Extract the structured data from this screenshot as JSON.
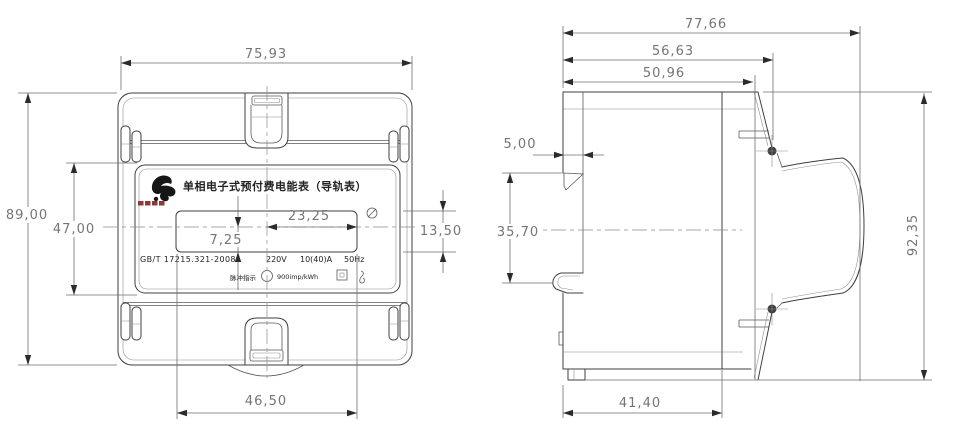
{
  "front": {
    "dims": {
      "overall_width": "75,93",
      "overall_height": "89,00",
      "label_height": "47,00",
      "lcd_half_width": "23,25",
      "lcd_offset": "7,25",
      "lcd_height": "13,50",
      "lcd_width": "46,50"
    },
    "label": {
      "title": "单相电子式预付费电能表（导轨表）",
      "standard": "GB/T 17215.321-2008",
      "voltage": "220V",
      "current": "10(40)A",
      "frequency": "50Hz",
      "pulse_caption": "脉冲指示",
      "pulse_rate": "900imp/kWh"
    }
  },
  "side": {
    "dims": {
      "overall_depth": "77,66",
      "terminal_depth": "56,63",
      "cover_depth": "50,96",
      "rail_notch_depth": "5,00",
      "rail_span": "35,70",
      "overall_height": "92,35",
      "base_depth": "41,40"
    }
  }
}
